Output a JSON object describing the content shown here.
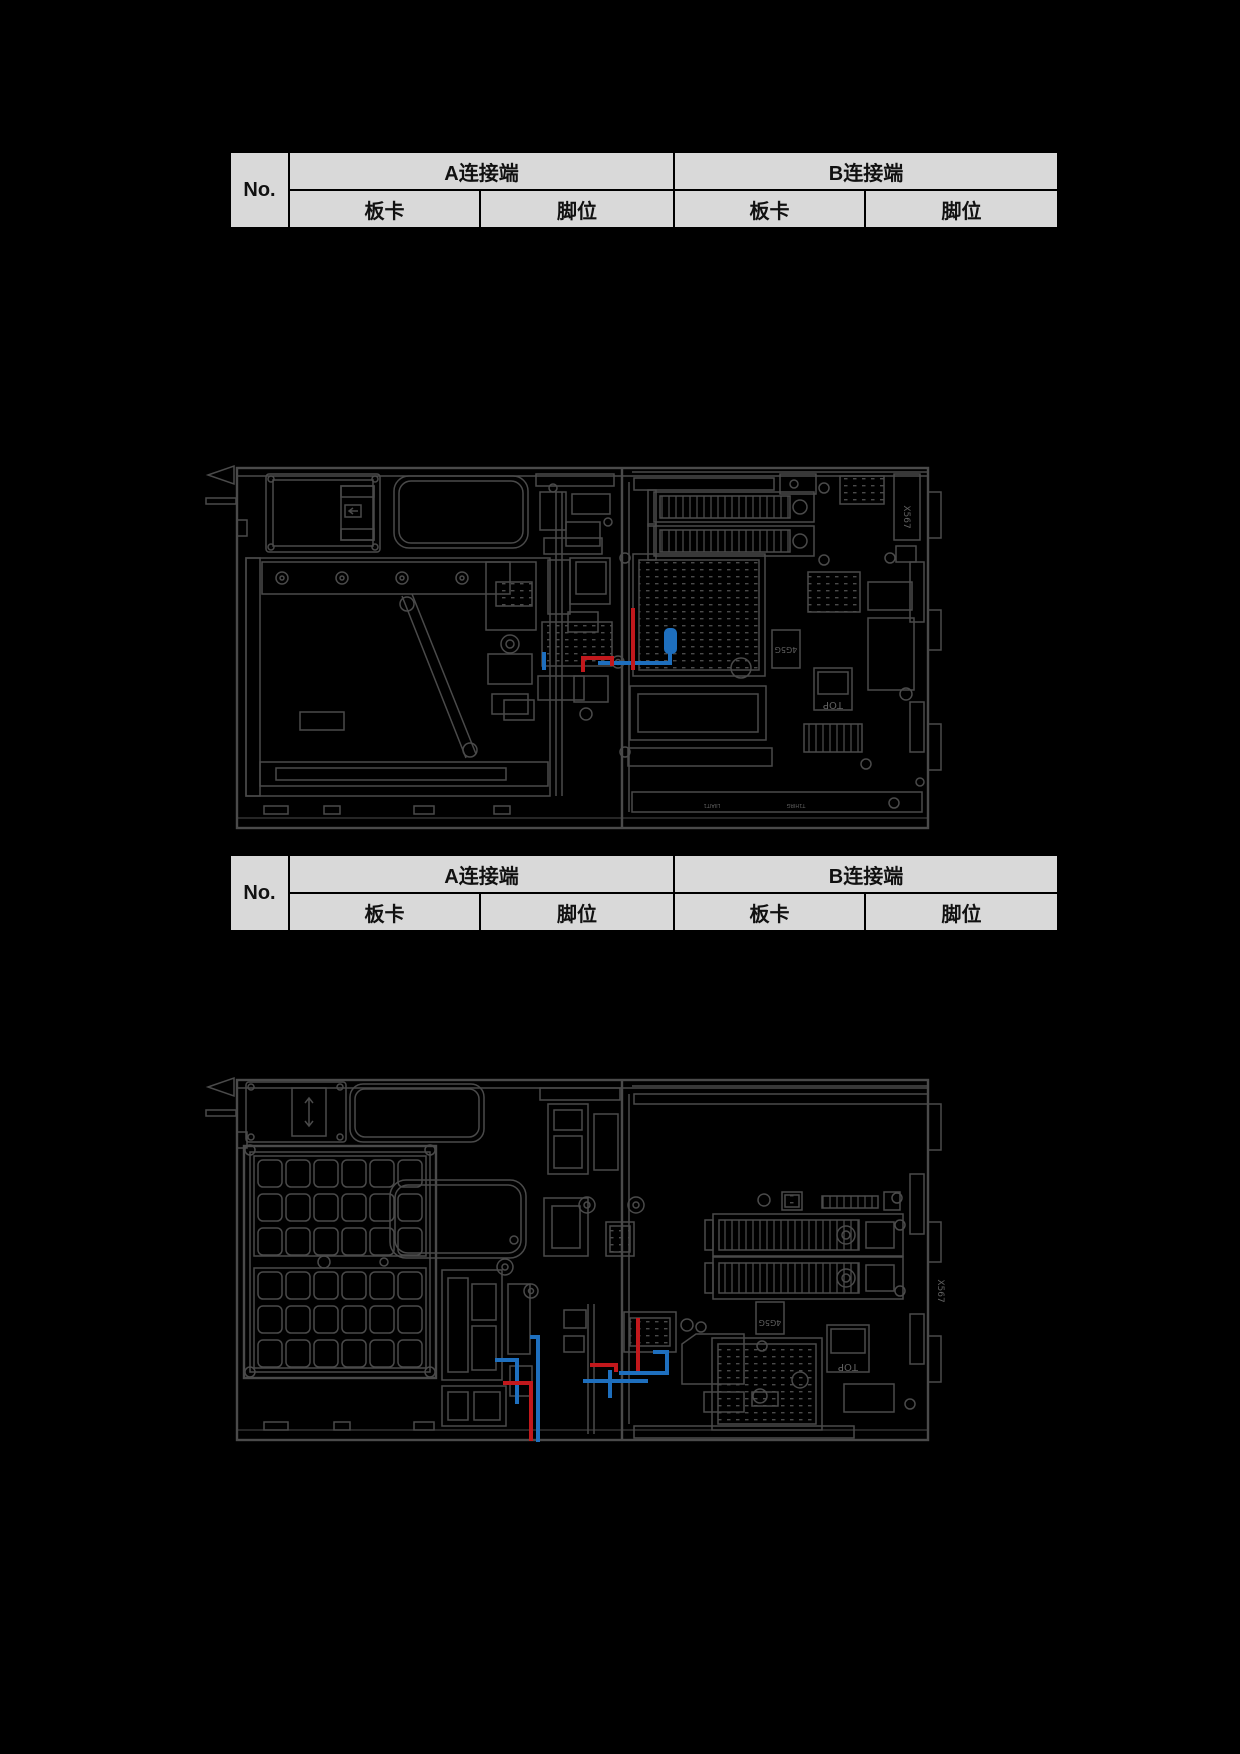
{
  "page": {
    "background": "#000000"
  },
  "colors": {
    "table_fill": "#d9d9d9",
    "table_border": "#000000",
    "table_text": "#111111",
    "diagram_line": "#4a4a4a",
    "cable_red": "#c2181c",
    "cable_blue": "#1e6fbe"
  },
  "tables": [
    {
      "no_label": "No.",
      "group_a": "A连接端",
      "group_b": "B连接端",
      "a_board": "板卡",
      "a_pin": "脚位",
      "b_board": "板卡",
      "b_pin": "脚位"
    },
    {
      "no_label": "No.",
      "group_a": "A连接端",
      "group_b": "B连接端",
      "a_board": "板卡",
      "a_pin": "脚位",
      "b_board": "板卡",
      "b_pin": "脚位"
    }
  ],
  "diagram1": {
    "labels": {
      "x567": "X567",
      "chip": "4G5G",
      "top": "TOP",
      "rail_left": "LIIAIT1",
      "rail_right": "T1HIRG"
    }
  },
  "diagram2": {
    "labels": {
      "x567": "X567",
      "chip": "4G5G",
      "top": "TOP"
    }
  }
}
